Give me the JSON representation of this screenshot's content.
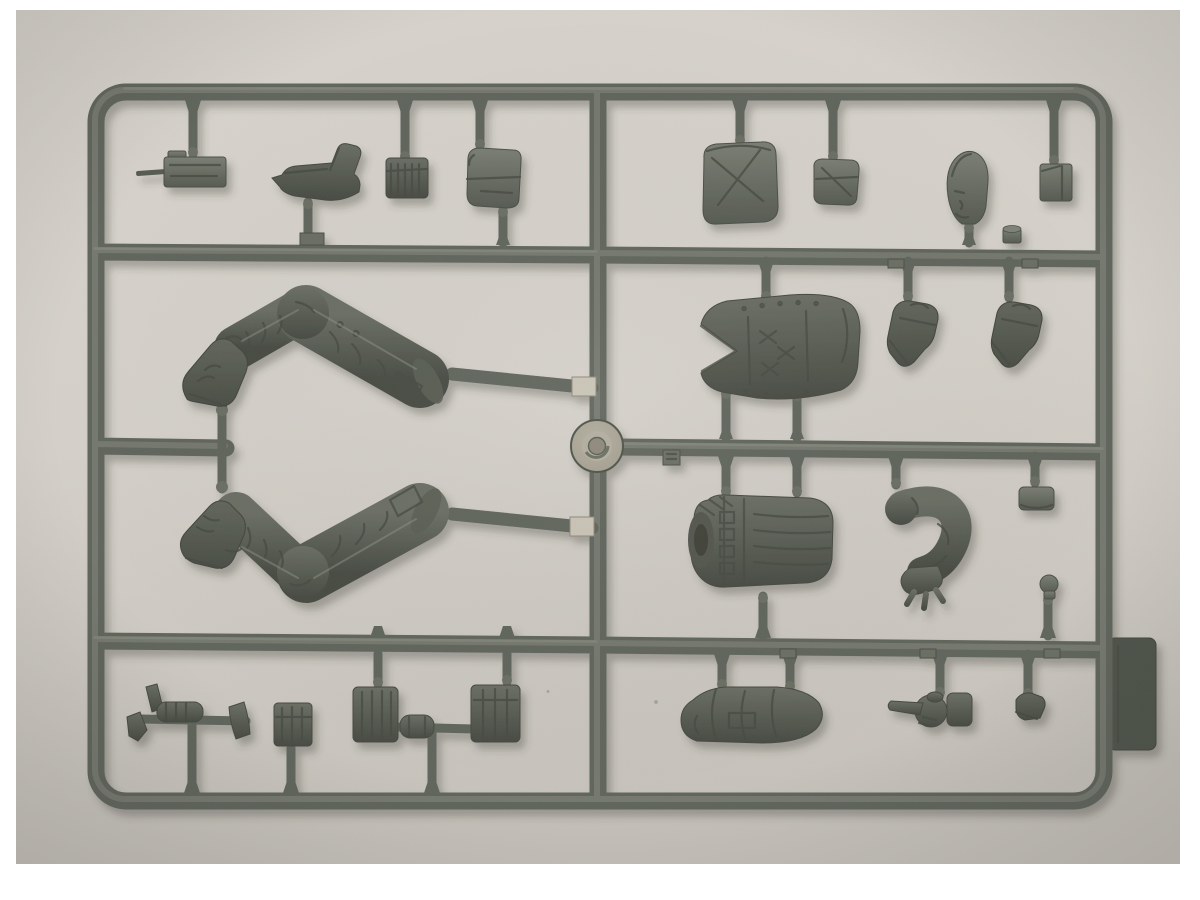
{
  "scene": {
    "type": "photograph",
    "description": "Top-down photo of a grey styrene injection-moulded sprue (runner frame) holding unassembled military figure model parts: two bent legs with boots, armoured vest torso, waist section with belt gear, bent arm, hands, ankle boots, a head, radio, pistol and assorted pouches. A round injection gate hub sits at the centre of the frame.",
    "surface": "light warm-grey backing board",
    "border": "white photo margin around the print"
  },
  "palette": {
    "paper": "#ffffff",
    "bg-top": "#d7d3cc",
    "bg-mid": "#d5d1ca",
    "bg-bottom": "#c6c2bb",
    "rail-base": "#61655c",
    "rail-dark": "#4b4f47",
    "rail-light": "#7f8378",
    "rail-sheen": "#929687",
    "part-light": "#7a7e73",
    "part-base": "#6a6e64",
    "part-dark": "#565a51",
    "part-deep": "#474b42",
    "boot-dark": "#4a4e45",
    "hub-outer": "#a19c8d",
    "hub-mid": "#b3ae9f",
    "hub-core": "#8d8879",
    "tab-light": "#c9c4b6",
    "shadow": "#3a3d35"
  },
  "parts": {
    "frame": {
      "label": "Sprue runner frame with internal cross runners"
    },
    "hub": {
      "label": "Circular injection gate hub"
    },
    "radio": {
      "label": "Radio handset with antenna"
    },
    "pistol": {
      "label": "Pistol"
    },
    "ribbed_pouch": {
      "label": "Ribbed ammunition pouch"
    },
    "flap_pouch": {
      "label": "Utility pouch with flap"
    },
    "rucksack": {
      "label": "Large rucksack pouch"
    },
    "small_pouch": {
      "label": "Small belt pouch"
    },
    "head": {
      "label": "Figure head"
    },
    "case": {
      "label": "Square equipment case"
    },
    "small_cylinder": {
      "label": "Small cylindrical fitting"
    },
    "leg_upper": {
      "label": "Bent leg with boot, knee up"
    },
    "leg_lower": {
      "label": "Bent leg with boot, knee down"
    },
    "vest": {
      "label": "Upper torso with armoured vest"
    },
    "boot_a": {
      "label": "Ankle boot"
    },
    "boot_b": {
      "label": "Ankle boot"
    },
    "waist": {
      "label": "Lower torso waist section with belt gear"
    },
    "arm": {
      "label": "Bent arm with open hand"
    },
    "cap": {
      "label": "Cylindrical cap fitting"
    },
    "knob": {
      "label": "Small knob fitting"
    },
    "mitten": {
      "label": "Forearm with mitten glove"
    },
    "hand": {
      "label": "Pointing hand"
    },
    "heel": {
      "label": "Boot heel piece"
    },
    "sidearm_cluster": {
      "label": "Sidearm and accessory cluster on sub-runner"
    },
    "box_pouch": {
      "label": "Box pouch"
    },
    "pouch_left": {
      "label": "Canvas pouch"
    },
    "canteen": {
      "label": "Canteen cylinder part"
    },
    "pouch_right": {
      "label": "Canvas pouch"
    },
    "mold_tab": {
      "label": "Mould ejection tab on right rail"
    },
    "gate_tags": {
      "label": "Moulded part-number tags"
    },
    "shiny_tabs": {
      "label": "Shiny injection gate tabs"
    }
  }
}
